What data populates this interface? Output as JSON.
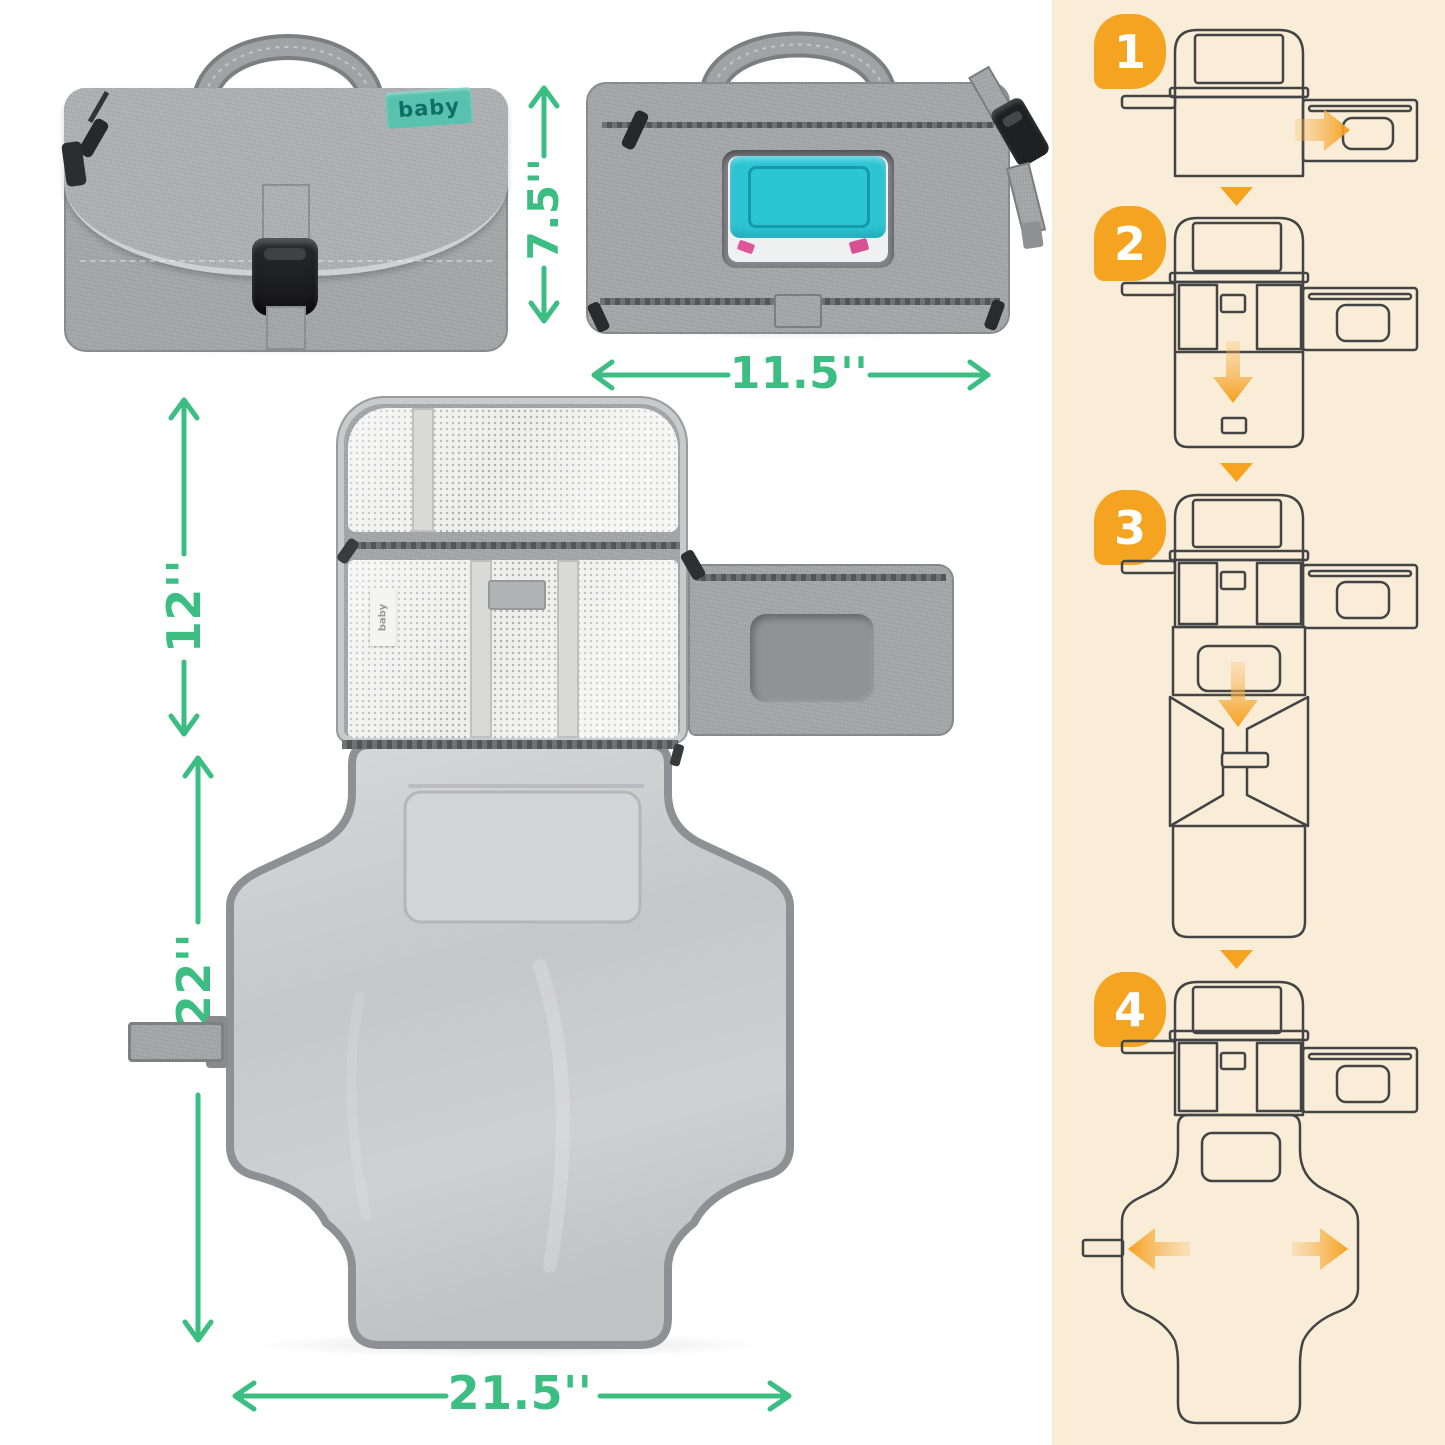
{
  "canvas": {
    "background": "#ffffff",
    "panel_background": "#faedd8"
  },
  "brand": {
    "folded_tag": "baby",
    "unfolded_tag": "baby"
  },
  "dimensions": {
    "folded_height": {
      "label": "7.5''"
    },
    "folded_width": {
      "label": "11.5''"
    },
    "flap_height": {
      "label": "12''"
    },
    "pad_height": {
      "label": "22''"
    },
    "pad_width": {
      "label": "21.5''"
    }
  },
  "steps": [
    {
      "number": "1"
    },
    {
      "number": "2"
    },
    {
      "number": "3"
    },
    {
      "number": "4"
    }
  ],
  "colors": {
    "dimension_green": "#3cbe83",
    "step_orange": "#f5a422",
    "wipes_teal": "#2bc5d6",
    "tag_teal": "#58c2ae",
    "fabric_gray": "#a3a4a6",
    "pad_gray": "#c9cacc"
  },
  "icons": {
    "dimension_arrows": "double-headed-arrow-icon",
    "fold_direction": [
      "right-arrow-icon",
      "down-arrow-icon",
      "left-arrow-icon"
    ],
    "step_connector": "down-triangle-icon"
  }
}
